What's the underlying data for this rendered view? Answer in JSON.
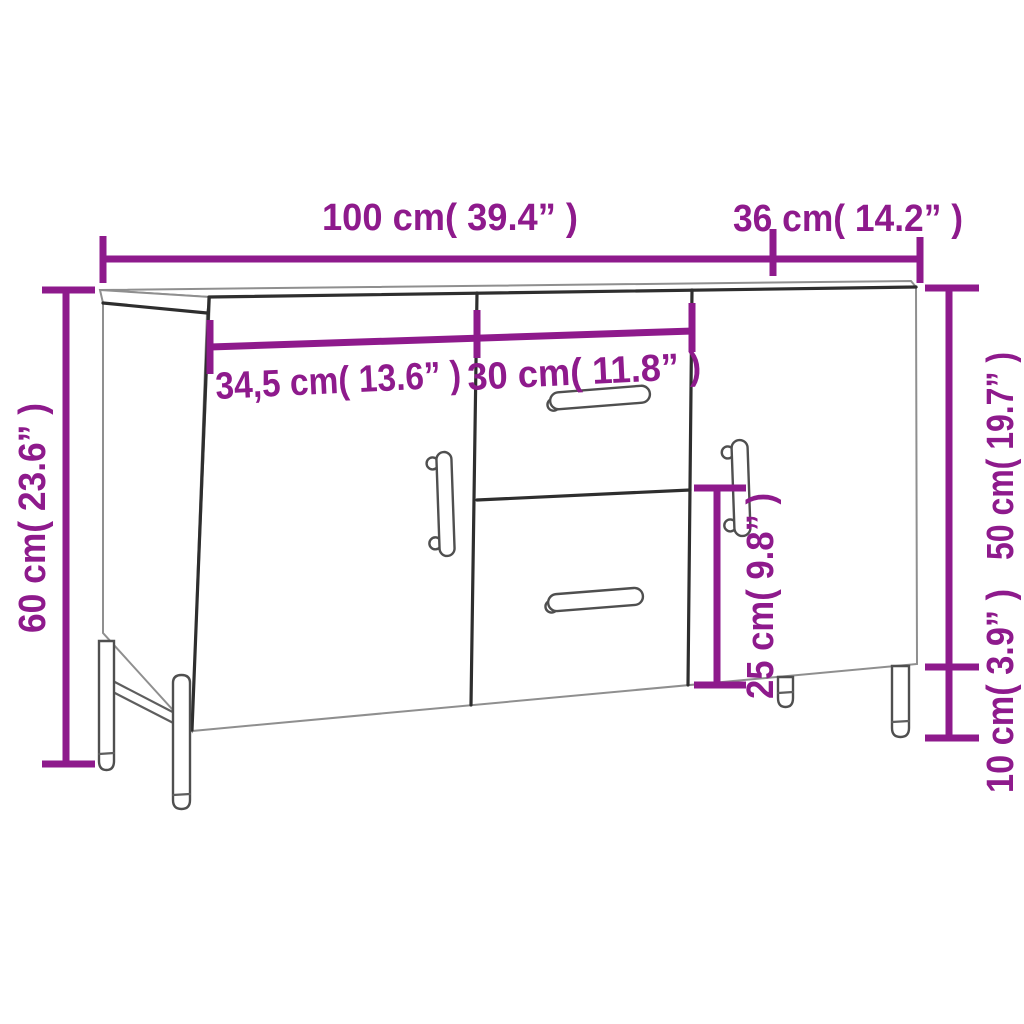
{
  "page": {
    "background": "#ffffff"
  },
  "diagram": {
    "subject": "sideboard-with-two-doors-two-drawers-on-metal-legs",
    "accent_color": "#8E1A8C",
    "line_color_dark": "#2e2e2e",
    "line_color_light": "#8f8f8f",
    "labels": {
      "overall_width": "100 cm( 39.4” )",
      "depth": "36 cm( 14.2” )",
      "overall_height": "60 cm( 23.6” )",
      "door_width": "34,5 cm( 13.6” )",
      "drawer_width": "30 cm( 11.8” )",
      "carcass_height": "50 cm( 19.7” )",
      "drawer_height": "25 cm( 9.8” )",
      "leg_height": "10 cm( 3.9” )"
    }
  }
}
